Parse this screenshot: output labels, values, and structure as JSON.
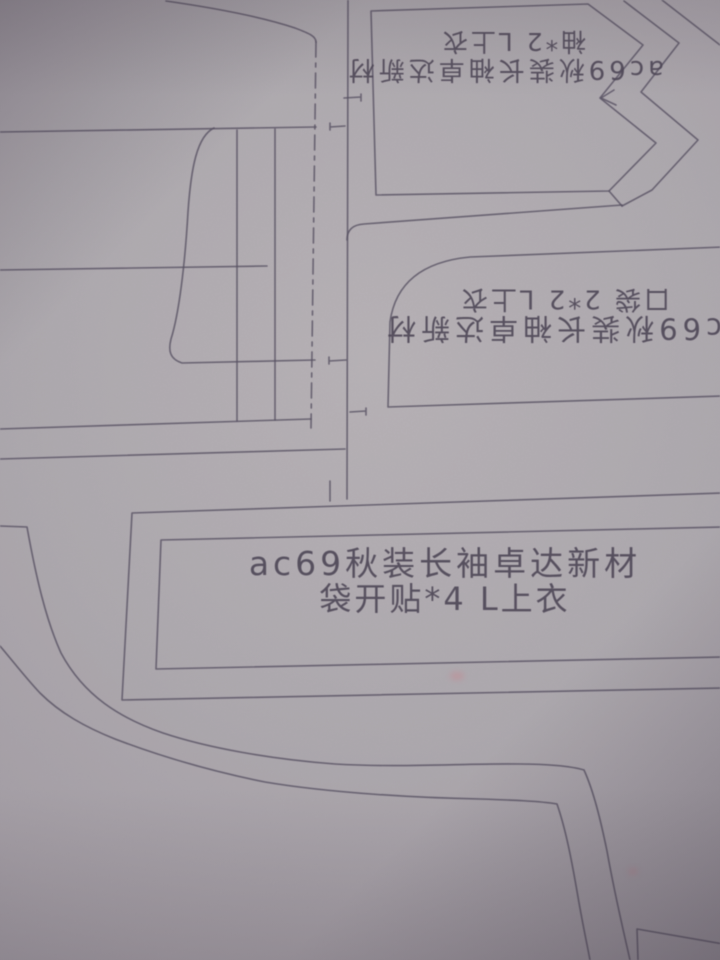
{
  "photo": {
    "subject": "sewing pattern marker sheet",
    "labels": {
      "top_right_piece": {
        "line1": "ac69秋装长袖卓达新材",
        "line2": "袖*2 L上衣",
        "orientation": "rotated-180"
      },
      "middle_right_piece": {
        "line1": "c69秋装长袖卓达新材",
        "line2": "口袋 2*2 L上衣",
        "orientation": "rotated-180"
      },
      "center_piece": {
        "line1": "ac69秋装长袖卓达新材",
        "line2": "袋开贴*4 L上衣",
        "orientation": "upright"
      }
    },
    "colors": {
      "paper": "#aca7ad",
      "line": "#575061",
      "text": "#4d4656"
    }
  }
}
